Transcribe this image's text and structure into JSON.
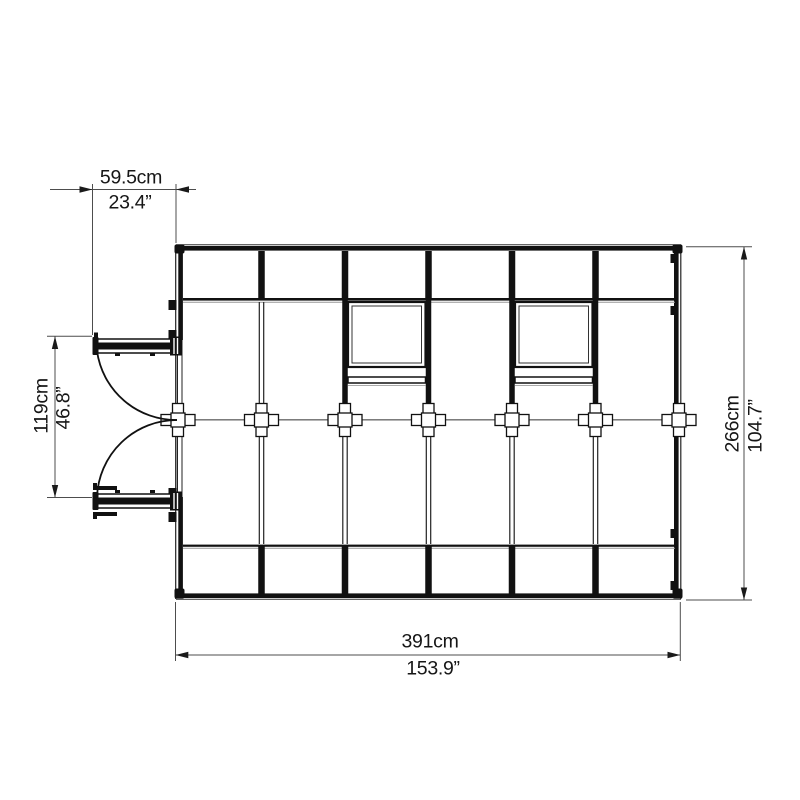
{
  "dimensions": {
    "door_width": {
      "cm": "59.5cm",
      "inch": "23.4”"
    },
    "door_opening": {
      "cm": "119cm",
      "inch": "46.8”"
    },
    "depth": {
      "cm": "266cm",
      "inch": "104.7”"
    },
    "width": {
      "cm": "391cm",
      "inch": "153.9”"
    }
  },
  "colors": {
    "structure_line": "#1a1a1a",
    "secondary_line": "#999999",
    "dimension_line": "#4d4d4d",
    "background": "#ffffff"
  }
}
